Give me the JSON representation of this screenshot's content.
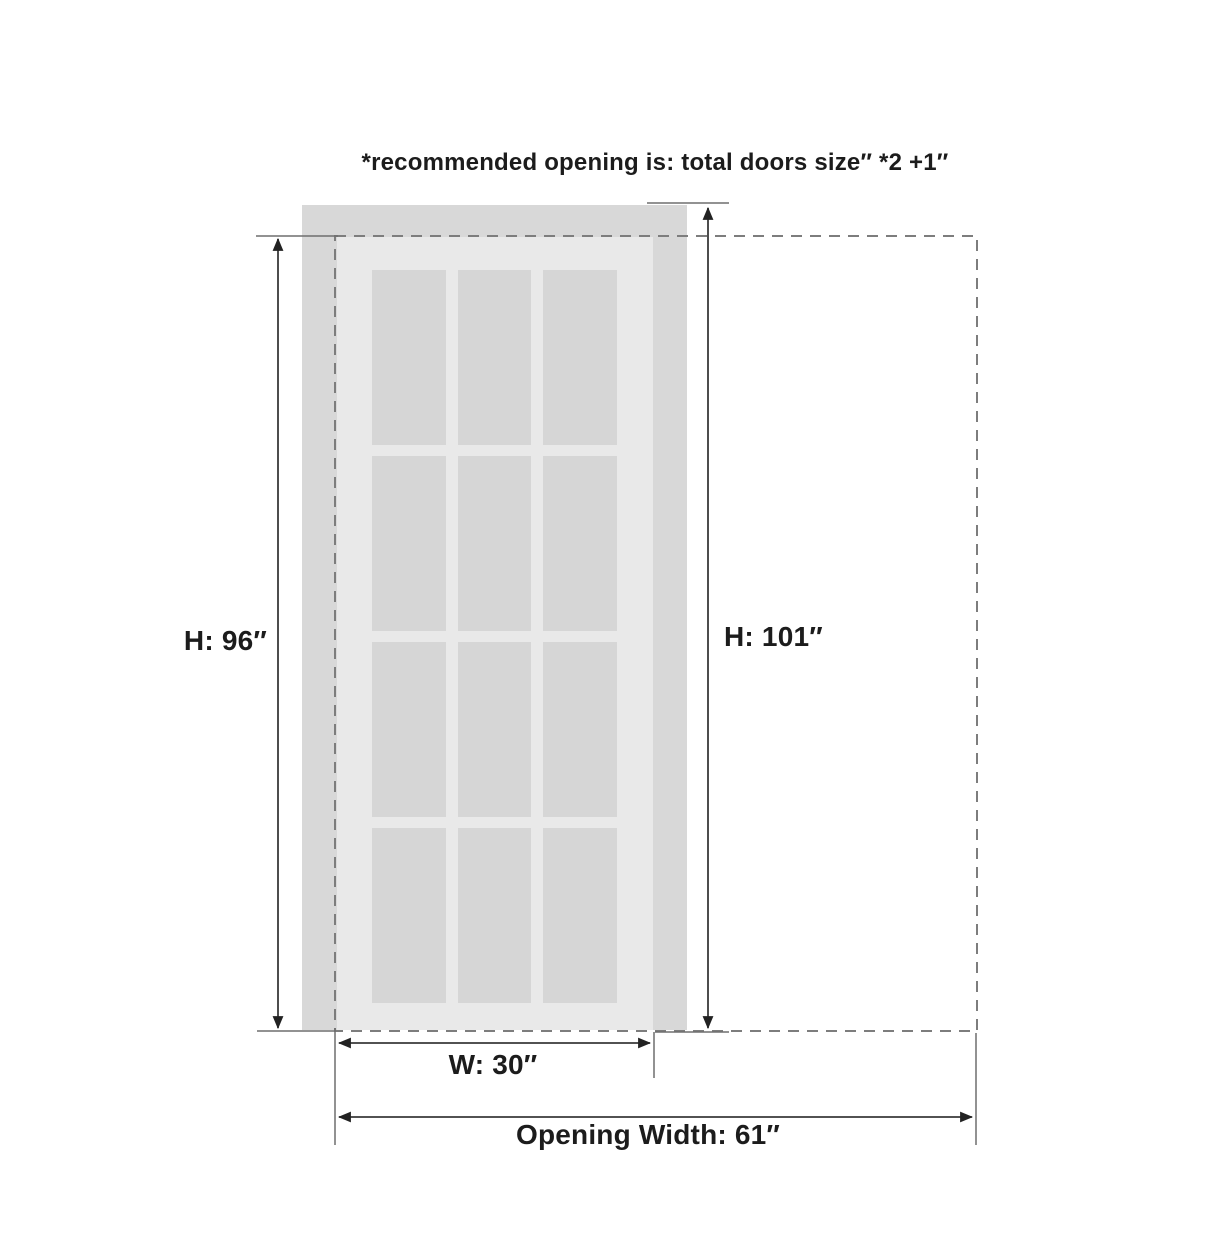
{
  "title": "*recommended opening is: total doors size″ *2 +1″",
  "door": {
    "width_label": "W: 30″",
    "height_label": "H: 96″",
    "width_in": 30,
    "height_in": 96,
    "pane_grid": {
      "columns": 3,
      "rows": 4
    }
  },
  "opening": {
    "width_label": "Opening Width: 61″",
    "height_label": "H: 101″",
    "width_in": 61,
    "height_in": 101
  },
  "colors": {
    "background": "#ffffff",
    "frame_panel": "#d8d8d8",
    "door_slab": "#e9e9e9",
    "glass_pane": "#d6d6d6",
    "dashed_opening": "#7d7d7d",
    "extension_line": "#6e6e6e",
    "dimension_line": "#3a3a3a",
    "arrow": "#222222",
    "text": "#1c1c1c"
  }
}
